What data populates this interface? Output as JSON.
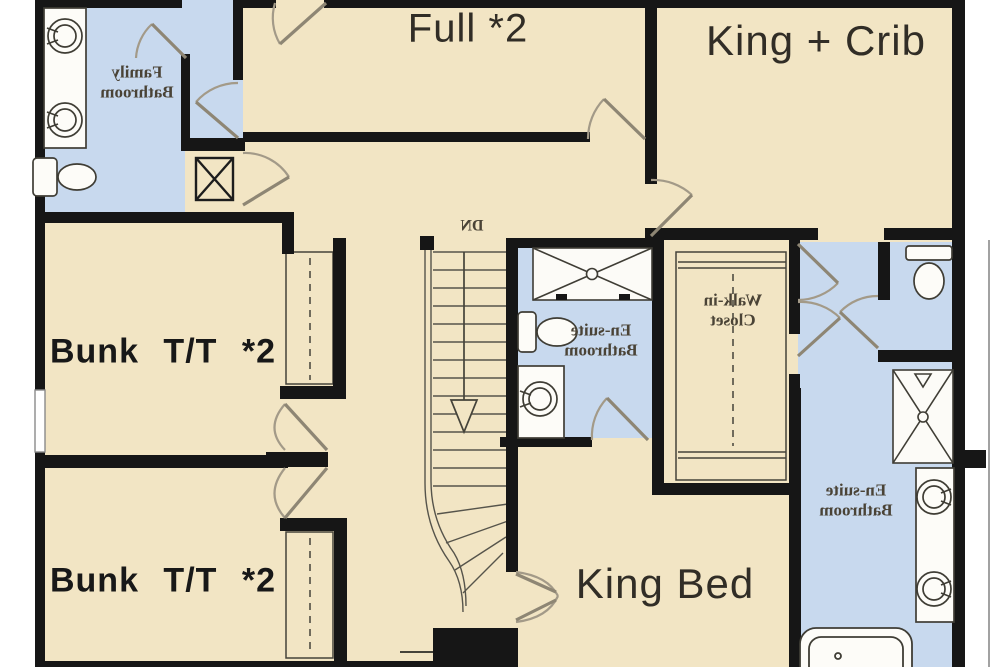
{
  "labels": {
    "full": "Full *2",
    "king_crib": "King + Crib",
    "king_bed": "King Bed",
    "bunk_top": "Bunk T/T *2",
    "bunk_bottom": "Bunk T/T *2",
    "stairs_dn": "DN",
    "family_bath_line1": "Family",
    "family_bath_line2": "Bathroom",
    "ensuite_center_line1": "En-suite",
    "ensuite_center_line2": "Bathroom",
    "ensuite_right_line1": "En-suite",
    "ensuite_right_line2": "Bathroom",
    "walk_in_line1": "Walk-in",
    "walk_in_line2": "Closet"
  },
  "colors": {
    "bedroom_fill": "#f2e5c4",
    "bathroom_fill": "#c8d9ee",
    "wall": "#161616",
    "label_dark": "#312d26",
    "label_serif": "#4a4336"
  },
  "fixtures": [
    "double-vanity-sink-icon",
    "toilet-icon",
    "linen-closet-icon",
    "staircase-down-icon",
    "shower-icon",
    "vanity-sink-icon",
    "walk-in-closet-icon",
    "bathtub-icon",
    "door-swing-icon",
    "window-icon"
  ]
}
